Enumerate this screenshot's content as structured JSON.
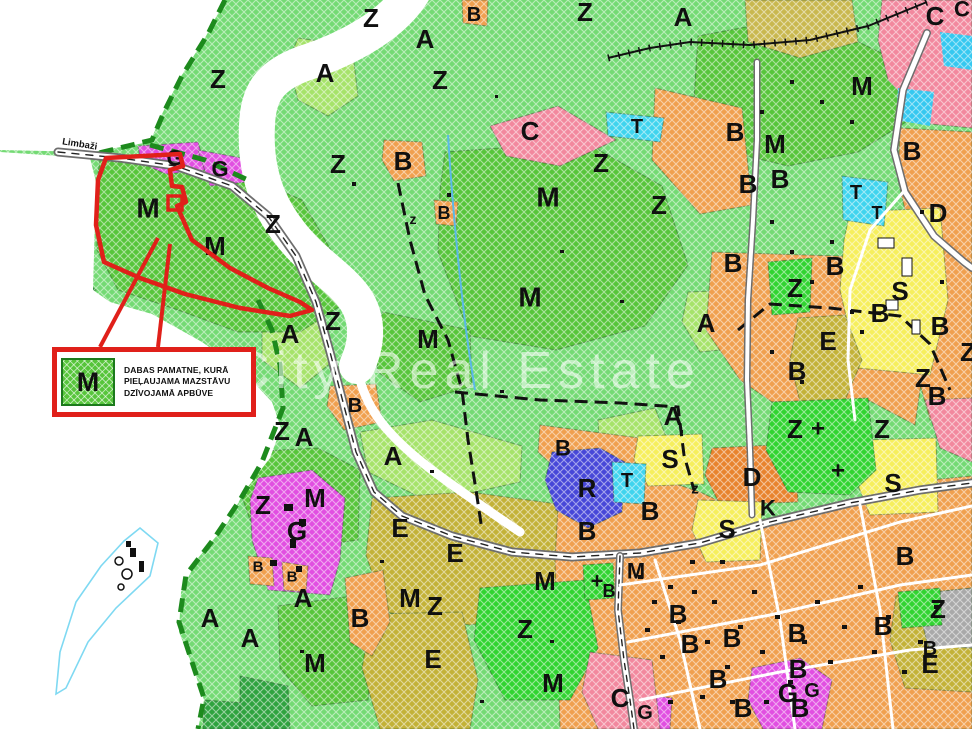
{
  "map": {
    "watermark": "City Real Estate",
    "road_label": "Limbaži",
    "legend": {
      "swatch_letter": "M",
      "line1": "DABAS PAMATNE, KURĀ",
      "line2": "PIEĻAUJAMA MAZSTĀVU",
      "line3": "DZĪVOJAMĀ APBŪVE"
    },
    "colors": {
      "base": "#74DA74",
      "forest": "#2FA33F",
      "M": "#57C53B",
      "A": "#A6E36A",
      "Zb": "#31D431",
      "B": "#F0A04F",
      "C": "#F2889E",
      "G": "#E14FE1",
      "R": "#4747D8",
      "T": "#3FD4EE",
      "S": "#F6EF5D",
      "D": "#E8832E",
      "E": "#C3B238",
      "E2": "#C9B84F",
      "gray": "#A9A9A9",
      "water": "#35C8F0",
      "lake_outline": "#7FD9F2",
      "stream": "#5AB8E8",
      "white": "#FFFFFF",
      "road_case": "#6E6E6E",
      "road_fill": "#FFFFFF",
      "road_dash": "#222222",
      "rail": "#111111",
      "boundary": "#1D8A1D",
      "plan_dash": "#111111",
      "red": "#E0201A"
    },
    "labels": [
      {
        "t": "Z",
        "x": 371,
        "y": 18
      },
      {
        "t": "Z",
        "x": 585,
        "y": 12
      },
      {
        "t": "A",
        "x": 683,
        "y": 17
      },
      {
        "t": "Z",
        "x": 218,
        "y": 79
      },
      {
        "t": "Z",
        "x": 440,
        "y": 80
      },
      {
        "t": "A",
        "x": 325,
        "y": 73
      },
      {
        "t": "Z",
        "x": 338,
        "y": 164
      },
      {
        "t": "Z",
        "x": 601,
        "y": 163
      },
      {
        "t": "Z",
        "x": 659,
        "y": 205
      },
      {
        "t": "Z",
        "x": 273,
        "y": 224
      },
      {
        "t": "Z",
        "x": 333,
        "y": 321
      },
      {
        "t": "Z",
        "x": 282,
        "y": 431
      },
      {
        "t": "Z",
        "x": 263,
        "y": 505
      },
      {
        "t": "Z",
        "x": 435,
        "y": 606
      },
      {
        "t": "Z",
        "x": 525,
        "y": 629
      },
      {
        "t": "Z",
        "x": 795,
        "y": 288
      },
      {
        "t": "Z",
        "x": 795,
        "y": 429
      },
      {
        "t": "Z",
        "x": 882,
        "y": 429
      },
      {
        "t": "Z",
        "x": 923,
        "y": 378
      },
      {
        "t": "Z",
        "x": 968,
        "y": 352
      },
      {
        "t": "Z",
        "x": 938,
        "y": 609
      },
      {
        "t": "z",
        "x": 695,
        "y": 489,
        "s": 15
      },
      {
        "t": "z",
        "x": 413,
        "y": 219,
        "s": 14
      },
      {
        "t": "A",
        "x": 290,
        "y": 334
      },
      {
        "t": "A",
        "x": 393,
        "y": 456
      },
      {
        "t": "A",
        "x": 304,
        "y": 437
      },
      {
        "t": "A",
        "x": 673,
        "y": 416
      },
      {
        "t": "A",
        "x": 706,
        "y": 323
      },
      {
        "t": "A",
        "x": 210,
        "y": 618
      },
      {
        "t": "A",
        "x": 250,
        "y": 638
      },
      {
        "t": "A",
        "x": 303,
        "y": 598
      },
      {
        "t": "A",
        "x": 425,
        "y": 39
      },
      {
        "t": "M",
        "x": 148,
        "y": 208,
        "s": 28
      },
      {
        "t": "M",
        "x": 215,
        "y": 246
      },
      {
        "t": "M",
        "x": 548,
        "y": 197,
        "s": 28
      },
      {
        "t": "M",
        "x": 530,
        "y": 297,
        "s": 28
      },
      {
        "t": "M",
        "x": 428,
        "y": 339
      },
      {
        "t": "M",
        "x": 315,
        "y": 498
      },
      {
        "t": "M",
        "x": 315,
        "y": 663
      },
      {
        "t": "M",
        "x": 410,
        "y": 598
      },
      {
        "t": "M",
        "x": 545,
        "y": 581
      },
      {
        "t": "M",
        "x": 553,
        "y": 683
      },
      {
        "t": "M",
        "x": 862,
        "y": 86
      },
      {
        "t": "M",
        "x": 775,
        "y": 144
      },
      {
        "t": "M",
        "x": 636,
        "y": 571,
        "s": 22
      },
      {
        "t": "B",
        "x": 474,
        "y": 15,
        "s": 20
      },
      {
        "t": "B",
        "x": 403,
        "y": 161
      },
      {
        "t": "B",
        "x": 444,
        "y": 213,
        "s": 18
      },
      {
        "t": "B",
        "x": 735,
        "y": 132
      },
      {
        "t": "B",
        "x": 748,
        "y": 184
      },
      {
        "t": "B",
        "x": 780,
        "y": 179
      },
      {
        "t": "B",
        "x": 912,
        "y": 151
      },
      {
        "t": "B",
        "x": 733,
        "y": 263
      },
      {
        "t": "B",
        "x": 835,
        "y": 266
      },
      {
        "t": "B",
        "x": 880,
        "y": 313
      },
      {
        "t": "B",
        "x": 940,
        "y": 326
      },
      {
        "t": "B",
        "x": 797,
        "y": 371
      },
      {
        "t": "B",
        "x": 937,
        "y": 396
      },
      {
        "t": "B",
        "x": 355,
        "y": 406,
        "s": 20
      },
      {
        "t": "B",
        "x": 360,
        "y": 618
      },
      {
        "t": "B",
        "x": 258,
        "y": 567,
        "s": 15
      },
      {
        "t": "B",
        "x": 292,
        "y": 577,
        "s": 15
      },
      {
        "t": "B",
        "x": 563,
        "y": 448,
        "s": 22
      },
      {
        "t": "B",
        "x": 587,
        "y": 531
      },
      {
        "t": "B",
        "x": 650,
        "y": 511
      },
      {
        "t": "B",
        "x": 678,
        "y": 614
      },
      {
        "t": "B",
        "x": 690,
        "y": 644
      },
      {
        "t": "B",
        "x": 732,
        "y": 638
      },
      {
        "t": "B",
        "x": 797,
        "y": 633
      },
      {
        "t": "B",
        "x": 718,
        "y": 679
      },
      {
        "t": "B",
        "x": 743,
        "y": 708
      },
      {
        "t": "B",
        "x": 798,
        "y": 669
      },
      {
        "t": "B",
        "x": 883,
        "y": 626
      },
      {
        "t": "B",
        "x": 800,
        "y": 708
      },
      {
        "t": "B",
        "x": 905,
        "y": 556
      },
      {
        "t": "B",
        "x": 930,
        "y": 649,
        "s": 20
      },
      {
        "t": "B",
        "x": 609,
        "y": 591,
        "s": 18
      },
      {
        "t": "C",
        "x": 530,
        "y": 131
      },
      {
        "t": "C",
        "x": 935,
        "y": 16
      },
      {
        "t": "C",
        "x": 962,
        "y": 9,
        "s": 22
      },
      {
        "t": "C",
        "x": 620,
        "y": 698
      },
      {
        "t": "G",
        "x": 175,
        "y": 158,
        "s": 22
      },
      {
        "t": "G",
        "x": 220,
        "y": 169,
        "s": 22
      },
      {
        "t": "G",
        "x": 297,
        "y": 531
      },
      {
        "t": "G",
        "x": 645,
        "y": 713,
        "s": 20
      },
      {
        "t": "G",
        "x": 788,
        "y": 693
      },
      {
        "t": "G",
        "x": 812,
        "y": 691,
        "s": 20
      },
      {
        "t": "T",
        "x": 637,
        "y": 127,
        "s": 20
      },
      {
        "t": "T",
        "x": 627,
        "y": 481,
        "s": 20
      },
      {
        "t": "T",
        "x": 856,
        "y": 193,
        "s": 20
      },
      {
        "t": "T",
        "x": 877,
        "y": 213,
        "s": 18
      },
      {
        "t": "D",
        "x": 752,
        "y": 477
      },
      {
        "t": "D",
        "x": 938,
        "y": 213
      },
      {
        "t": "K",
        "x": 768,
        "y": 508,
        "s": 22
      },
      {
        "t": "R",
        "x": 587,
        "y": 488
      },
      {
        "t": "S",
        "x": 670,
        "y": 459
      },
      {
        "t": "S",
        "x": 727,
        "y": 529
      },
      {
        "t": "S",
        "x": 900,
        "y": 291
      },
      {
        "t": "S",
        "x": 893,
        "y": 483
      },
      {
        "t": "E",
        "x": 400,
        "y": 528
      },
      {
        "t": "E",
        "x": 455,
        "y": 553
      },
      {
        "t": "E",
        "x": 433,
        "y": 659
      },
      {
        "t": "E",
        "x": 828,
        "y": 341
      },
      {
        "t": "E",
        "x": 930,
        "y": 664
      },
      {
        "t": "+",
        "x": 818,
        "y": 429,
        "s": 24
      },
      {
        "t": "+",
        "x": 838,
        "y": 471,
        "s": 24
      },
      {
        "t": "+",
        "x": 597,
        "y": 581,
        "s": 22
      }
    ]
  }
}
